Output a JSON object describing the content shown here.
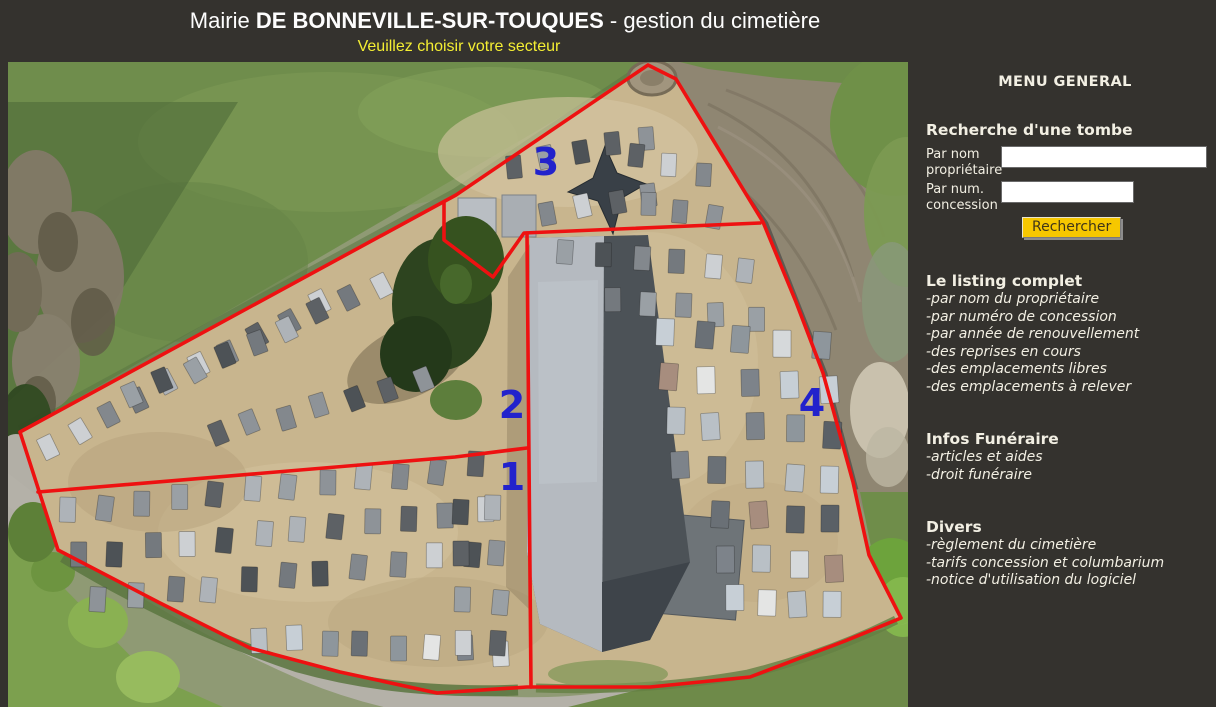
{
  "header": {
    "title_prefix": "Mairie ",
    "title_main": "DE BONNEVILLE-SUR-TOUQUES",
    "title_suffix": " - gestion du cimetière",
    "subtitle": "Veuillez choisir votre secteur"
  },
  "menu": {
    "title": "MENU GENERAL",
    "search": {
      "heading": "Recherche d'une tombe",
      "by_name_label": "Par nom propriétaire",
      "by_name_value": "",
      "by_num_label": "Par num. concession",
      "by_num_value": "",
      "button_label": "Rechercher"
    },
    "sections": [
      {
        "heading": "Le listing complet",
        "items": [
          "-par nom du propriétaire",
          "-par numéro de concession",
          "-par année de renouvellement",
          "-des reprises en cours",
          "-des emplacements libres",
          "-des emplacements à relever"
        ]
      },
      {
        "heading": "Infos Funéraire",
        "items": [
          "-articles et aides",
          "-droit funéraire"
        ]
      },
      {
        "heading": "Divers",
        "items": [
          "-règlement du cimetière",
          "-tarifs concession et columbarium",
          "-notice d'utilisation du logiciel"
        ]
      }
    ]
  },
  "theme": {
    "background": "#34322e",
    "subtitle": "#f4ee33",
    "button_bg": "#f6c700",
    "button_text": "#3f3519",
    "boundary": "#ee1111",
    "sector_label": "#2222cc"
  },
  "map": {
    "sectors": [
      {
        "label": "3",
        "x": 538,
        "y": 100
      },
      {
        "label": "2",
        "x": 504,
        "y": 343
      },
      {
        "label": "1",
        "x": 504,
        "y": 415
      },
      {
        "label": "4",
        "x": 804,
        "y": 341
      }
    ],
    "palettes": {
      "grays": [
        "#5d6165",
        "#74797e",
        "#8e9398",
        "#aeb3b8",
        "#cdd0d3",
        "#4d5256",
        "#83888d",
        "#9aa0a5"
      ],
      "light": [
        "#b9c0c6",
        "#d6d9db",
        "#8e969c",
        "#6a7076",
        "#c7cfd6",
        "#e4e5e4",
        "#a78d7e",
        "#7d838a",
        "#5a6066"
      ]
    },
    "grave_clusters": [
      {
        "seed": 11,
        "x": 40,
        "y": 385,
        "cols": 10,
        "dx": 30,
        "dy": -16,
        "w": 15,
        "h": 23,
        "angle": -27,
        "palette": "grays"
      },
      {
        "seed": 12,
        "x": 125,
        "y": 335,
        "cols": 9,
        "dx": 31,
        "dy": -14,
        "w": 15,
        "h": 23,
        "angle": -25,
        "palette": "grays"
      },
      {
        "seed": 13,
        "x": 210,
        "y": 372,
        "cols": 7,
        "dx": 34,
        "dy": -9,
        "w": 15,
        "h": 23,
        "angle": -18,
        "palette": "grays"
      },
      {
        "seed": 21,
        "x": 60,
        "y": 448,
        "cols": 12,
        "dx": 37,
        "dy": -4,
        "w": 16,
        "h": 25,
        "angle": 4,
        "palette": "grays"
      },
      {
        "seed": 22,
        "x": 70,
        "y": 494,
        "cols": 12,
        "dx": 37,
        "dy": -4,
        "w": 16,
        "h": 25,
        "angle": 3,
        "palette": "grays"
      },
      {
        "seed": 23,
        "x": 92,
        "y": 540,
        "cols": 11,
        "dx": 37,
        "dy": -5,
        "w": 16,
        "h": 25,
        "angle": 2,
        "palette": "grays"
      },
      {
        "seed": 24,
        "x": 252,
        "y": 576,
        "cols": 8,
        "dx": 34,
        "dy": 2,
        "w": 16,
        "h": 25,
        "angle": 0,
        "palette": "light"
      },
      {
        "seed": 25,
        "x": 452,
        "y": 448,
        "cols": 2,
        "rows": 4,
        "dx": 34,
        "dy": 0,
        "rdx": 2,
        "rdy": 45,
        "w": 16,
        "h": 25,
        "angle": 2,
        "palette": "grays"
      },
      {
        "seed": 31,
        "x": 505,
        "y": 103,
        "cols": 5,
        "dx": 33,
        "dy": -7,
        "w": 15,
        "h": 23,
        "angle": -8,
        "palette": "grays"
      },
      {
        "seed": 32,
        "x": 540,
        "y": 150,
        "cols": 4,
        "dx": 34,
        "dy": -6,
        "w": 15,
        "h": 23,
        "angle": -8,
        "palette": "grays"
      },
      {
        "seed": 33,
        "x": 628,
        "y": 92,
        "cols": 3,
        "dx": 33,
        "dy": 9,
        "w": 15,
        "h": 23,
        "angle": 5,
        "palette": "grays"
      },
      {
        "seed": 34,
        "x": 640,
        "y": 140,
        "cols": 3,
        "dx": 34,
        "dy": 8,
        "w": 15,
        "h": 23,
        "angle": 5,
        "palette": "grays"
      },
      {
        "seed": 35,
        "x": 560,
        "y": 190,
        "cols": 6,
        "dx": 36,
        "dy": 4,
        "w": 16,
        "h": 24,
        "angle": 2,
        "palette": "grays"
      },
      {
        "seed": 36,
        "x": 602,
        "y": 235,
        "cols": 5,
        "dx": 36,
        "dy": 5,
        "w": 16,
        "h": 24,
        "angle": 2,
        "palette": "grays"
      },
      {
        "seed": 41,
        "x": 655,
        "y": 270,
        "cols": 5,
        "dx": 40,
        "dy": 3,
        "w": 18,
        "h": 27,
        "angle": 1,
        "palette": "light"
      },
      {
        "seed": 42,
        "x": 660,
        "y": 315,
        "cols": 5,
        "dx": 40,
        "dy": 3,
        "w": 18,
        "h": 27,
        "angle": 1,
        "palette": "light"
      },
      {
        "seed": 43,
        "x": 665,
        "y": 360,
        "cols": 5,
        "dx": 40,
        "dy": 3,
        "w": 18,
        "h": 27,
        "angle": 1,
        "palette": "light"
      },
      {
        "seed": 44,
        "x": 670,
        "y": 405,
        "cols": 5,
        "dx": 38,
        "dy": 3,
        "w": 18,
        "h": 27,
        "angle": 1,
        "palette": "light"
      },
      {
        "seed": 45,
        "x": 715,
        "y": 450,
        "cols": 4,
        "dx": 36,
        "dy": 3,
        "w": 18,
        "h": 27,
        "angle": 0,
        "palette": "light"
      },
      {
        "seed": 46,
        "x": 720,
        "y": 495,
        "cols": 4,
        "dx": 35,
        "dy": 3,
        "w": 18,
        "h": 27,
        "angle": 0,
        "palette": "light"
      },
      {
        "seed": 47,
        "x": 726,
        "y": 538,
        "cols": 4,
        "dx": 33,
        "dy": 2,
        "w": 18,
        "h": 26,
        "angle": 0,
        "palette": "light"
      }
    ]
  }
}
